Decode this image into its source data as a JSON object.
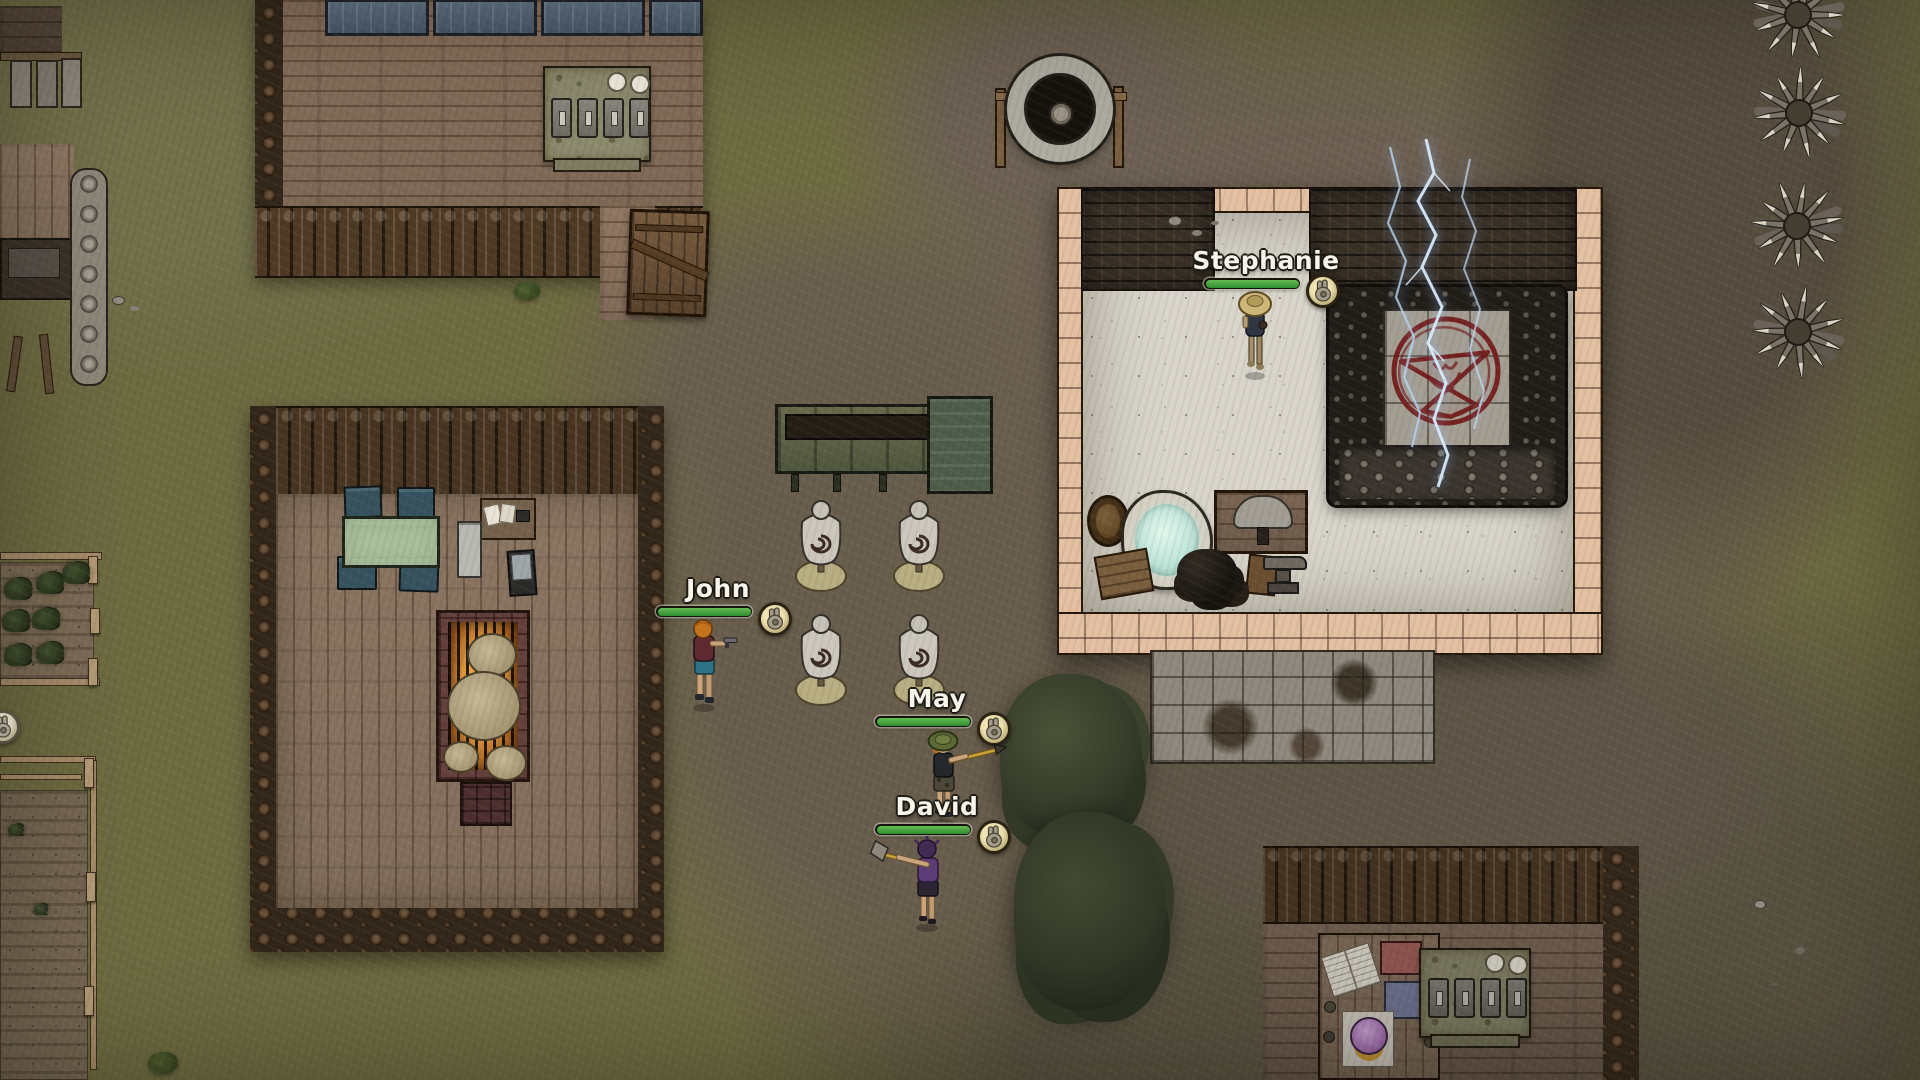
{
  "characters": [
    {
      "name": "Stephanie",
      "health_pct": 100,
      "status_icon": "fist-icon"
    },
    {
      "name": "John",
      "health_pct": 100,
      "status_icon": "fist-icon"
    },
    {
      "name": "May",
      "health_pct": 100,
      "status_icon": "fist-icon"
    },
    {
      "name": "David",
      "health_pct": 100,
      "status_icon": "fist-icon"
    }
  ],
  "edge_badge": {
    "status_icon": "fist-icon",
    "state": "inactive"
  },
  "colors": {
    "grass": "#6e6b41",
    "dirt": "#6d6052",
    "dirt_dark": "#554c3f",
    "wood_plank": "#937c67",
    "palisade_log": "#4e3a24",
    "brick_pale": "#e4c0a2",
    "brick_dark": "#393026",
    "stone_floor": "#d9d5cb",
    "skull_pile": "#211d18",
    "pentagram_red": "#701111",
    "lightning_blue": "#cfe4f8",
    "fire_glow": "#e8a344",
    "water_glow": "#bfe5da",
    "table_green": "#a9bf9b",
    "chair_teal": "#35525e",
    "solar_panel": "#55697c",
    "machine_green": "#617055",
    "mannequin_body": "#ccc7bd",
    "health_fill": "#3f9c38",
    "health_track": "#15150d",
    "name_text": "#f7f4ec",
    "name_outline": "#1d1b13",
    "status_icon_bg": "#f1e5b4",
    "status_icon_glyph": "#a39c8d",
    "spike_wood": "#7b7368",
    "spike_tip": "#d9d3c6",
    "tree_canopy": "#353d2a"
  }
}
